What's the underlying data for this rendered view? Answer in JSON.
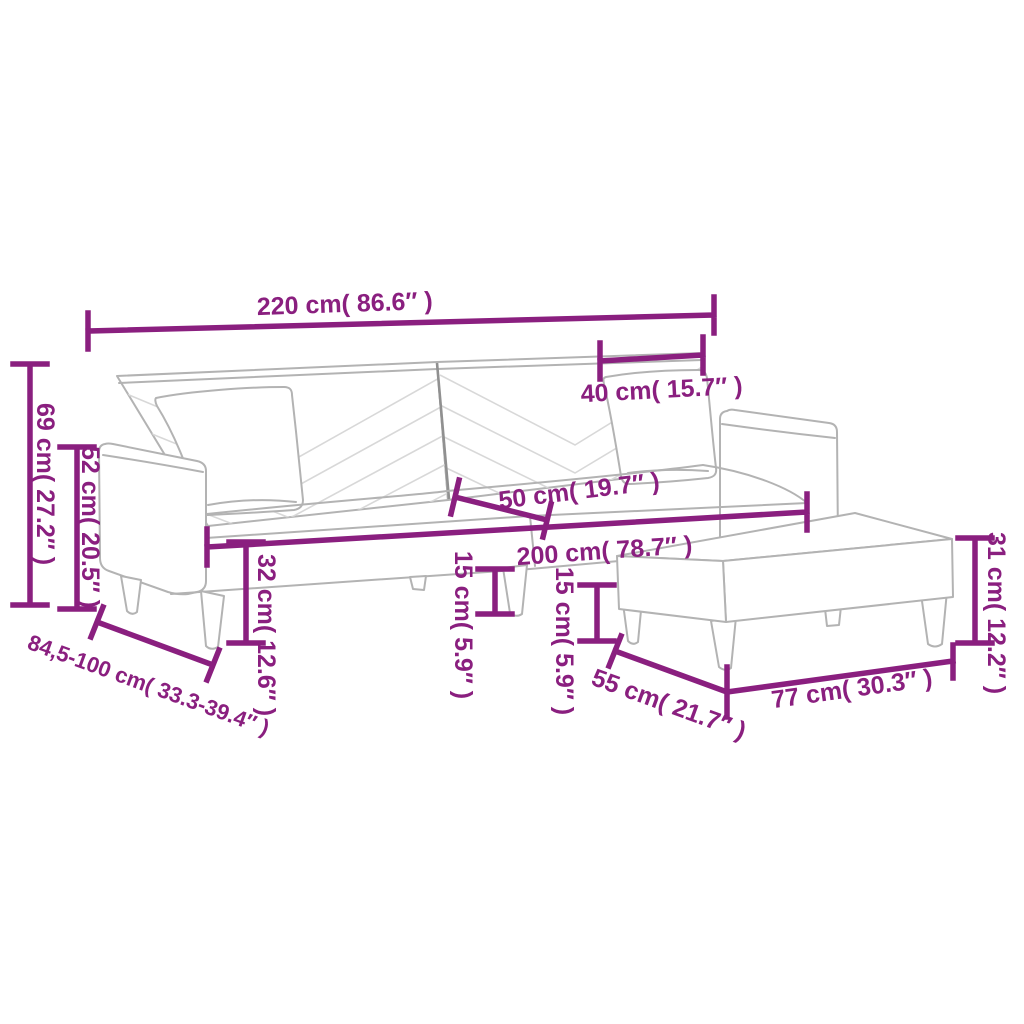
{
  "page": {
    "kind": "product-dimension-diagram",
    "subject": "2-seater sofa bed with two pillows and footstool"
  },
  "style": {
    "background": "#ffffff",
    "dimension_color": "#8a1f7f",
    "outline_color": "#b3b3b3",
    "divider_color": "#909090",
    "chevron_color": "#d8d8d8"
  },
  "dimensions": {
    "overall_width": "220 cm( 86.6″ )",
    "pillow_width": "40 cm( 15.7″ )",
    "back_height": "69 cm( 27.2″ )",
    "armrest_height": "52 cm( 20.5″ )",
    "seat_depth": "50 cm( 19.7″ )",
    "seat_width": "200 cm( 78.7″ )",
    "seat_height": "32 cm( 12.6″ )",
    "sofa_leg_height": "15 cm( 5.9″ )",
    "footstool_leg_height": "15 cm( 5.9″ )",
    "footstool_height": "31 cm( 12.2″ )",
    "adjustable_depth": "84,5-100 cm( 33.3-39.4″ )",
    "footstool_depth": "55 cm( 21.7″ )",
    "footstool_width": "77 cm( 30.3″ )"
  }
}
